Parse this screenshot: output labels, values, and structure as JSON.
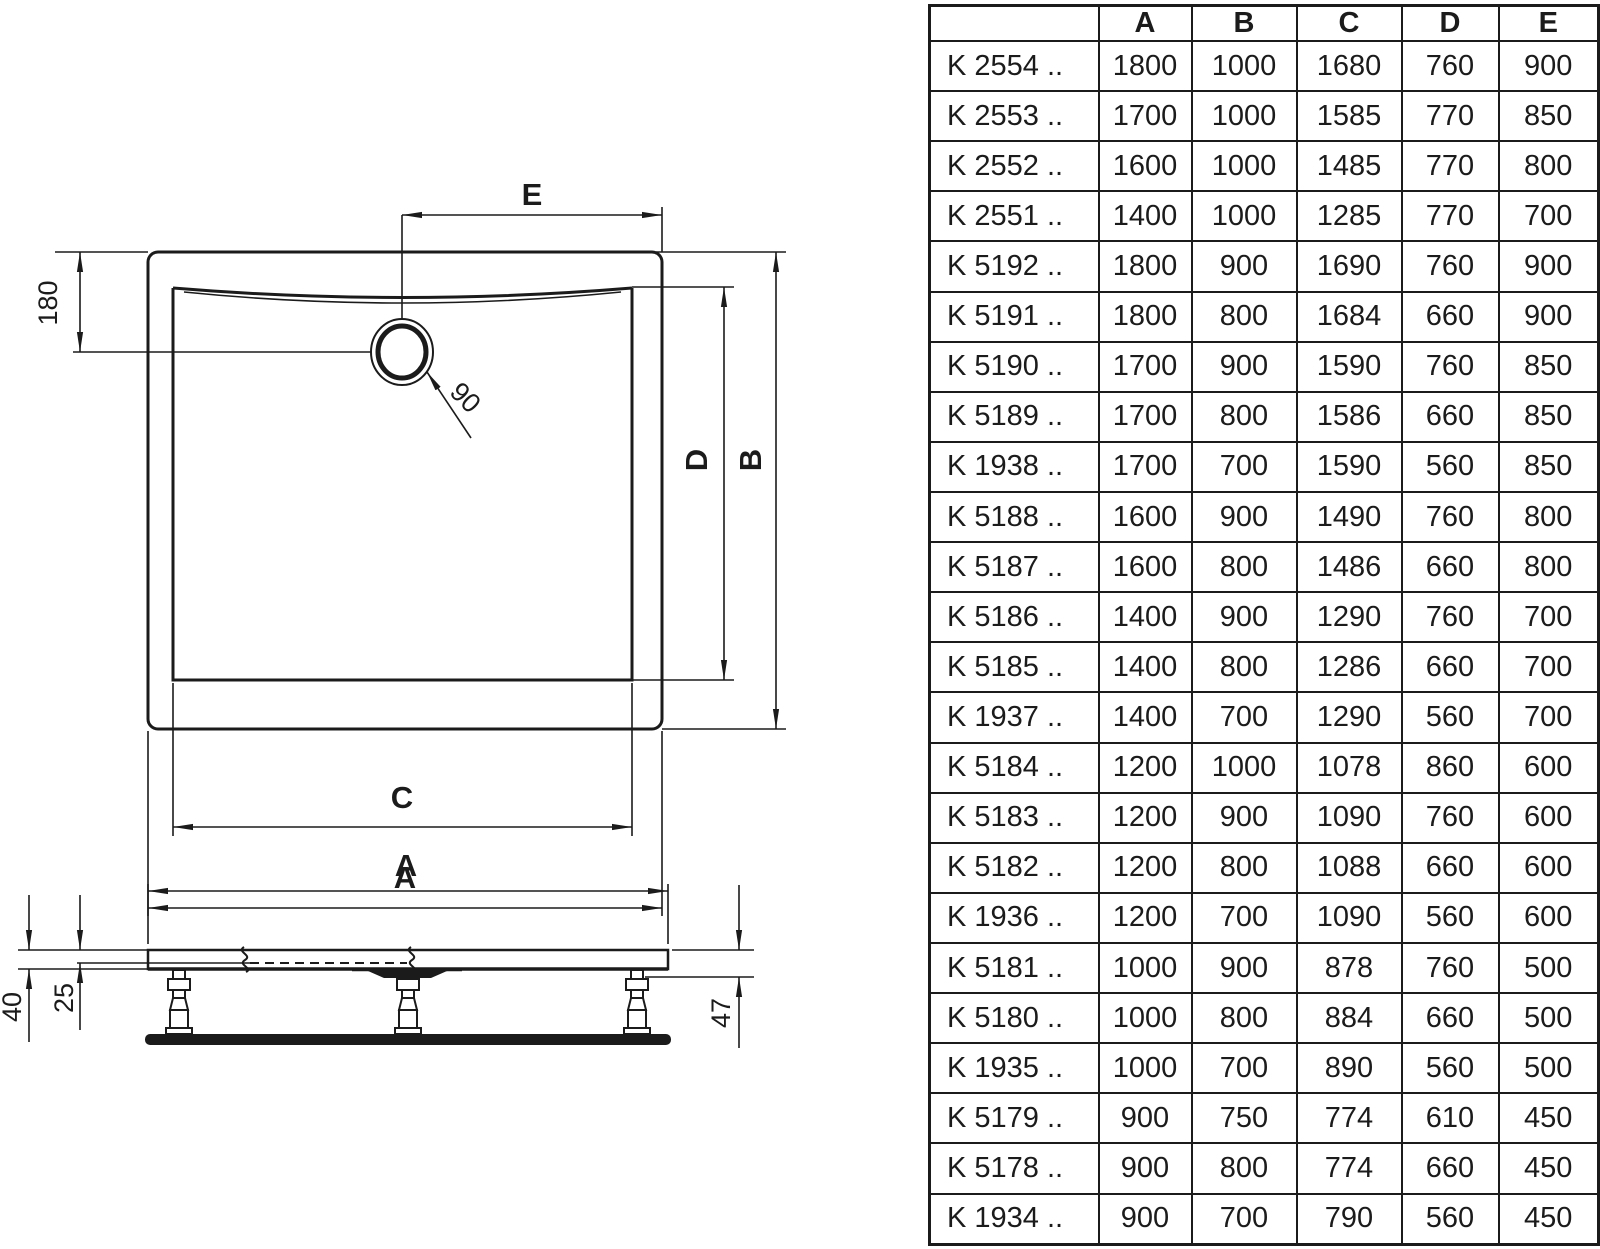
{
  "drawing": {
    "top_view": {
      "label_e": "E",
      "label_d": "D",
      "label_b": "B",
      "label_c": "C",
      "label_a": "A",
      "dim_180": "180",
      "dim_90": "90"
    },
    "side_view": {
      "label_a": "A",
      "dim_40": "40",
      "dim_25": "25",
      "dim_47": "47"
    }
  },
  "table": {
    "headers": [
      "",
      "A",
      "B",
      "C",
      "D",
      "E"
    ],
    "rows": [
      {
        "model": "K 2554 ..",
        "values": [
          1800,
          1000,
          1680,
          760,
          900
        ]
      },
      {
        "model": "K 2553 ..",
        "values": [
          1700,
          1000,
          1585,
          770,
          850
        ]
      },
      {
        "model": "K 2552 ..",
        "values": [
          1600,
          1000,
          1485,
          770,
          800
        ]
      },
      {
        "model": "K 2551 ..",
        "values": [
          1400,
          1000,
          1285,
          770,
          700
        ]
      },
      {
        "model": "K 5192 ..",
        "values": [
          1800,
          900,
          1690,
          760,
          900
        ]
      },
      {
        "model": "K 5191 ..",
        "values": [
          1800,
          800,
          1684,
          660,
          900
        ]
      },
      {
        "model": "K 5190 ..",
        "values": [
          1700,
          900,
          1590,
          760,
          850
        ]
      },
      {
        "model": "K 5189 ..",
        "values": [
          1700,
          800,
          1586,
          660,
          850
        ]
      },
      {
        "model": "K 1938 ..",
        "values": [
          1700,
          700,
          1590,
          560,
          850
        ]
      },
      {
        "model": "K 5188 ..",
        "values": [
          1600,
          900,
          1490,
          760,
          800
        ]
      },
      {
        "model": "K 5187 ..",
        "values": [
          1600,
          800,
          1486,
          660,
          800
        ]
      },
      {
        "model": "K 5186 ..",
        "values": [
          1400,
          900,
          1290,
          760,
          700
        ]
      },
      {
        "model": "K 5185 ..",
        "values": [
          1400,
          800,
          1286,
          660,
          700
        ]
      },
      {
        "model": "K 1937 ..",
        "values": [
          1400,
          700,
          1290,
          560,
          700
        ]
      },
      {
        "model": "K 5184 ..",
        "values": [
          1200,
          1000,
          1078,
          860,
          600
        ]
      },
      {
        "model": "K 5183 ..",
        "values": [
          1200,
          900,
          1090,
          760,
          600
        ]
      },
      {
        "model": "K 5182 ..",
        "values": [
          1200,
          800,
          1088,
          660,
          600
        ]
      },
      {
        "model": "K 1936 ..",
        "values": [
          1200,
          700,
          1090,
          560,
          600
        ]
      },
      {
        "model": "K 5181 ..",
        "values": [
          1000,
          900,
          878,
          760,
          500
        ]
      },
      {
        "model": "K 5180 ..",
        "values": [
          1000,
          800,
          884,
          660,
          500
        ]
      },
      {
        "model": "K 1935 ..",
        "values": [
          1000,
          700,
          890,
          560,
          500
        ]
      },
      {
        "model": "K 5179 ..",
        "values": [
          900,
          750,
          774,
          610,
          450
        ]
      },
      {
        "model": "K 5178 ..",
        "values": [
          900,
          800,
          774,
          660,
          450
        ]
      },
      {
        "model": "K 1934 ..",
        "values": [
          900,
          700,
          790,
          560,
          450
        ]
      }
    ]
  },
  "colors": {
    "line": "#1b1b1b",
    "background": "#ffffff"
  }
}
